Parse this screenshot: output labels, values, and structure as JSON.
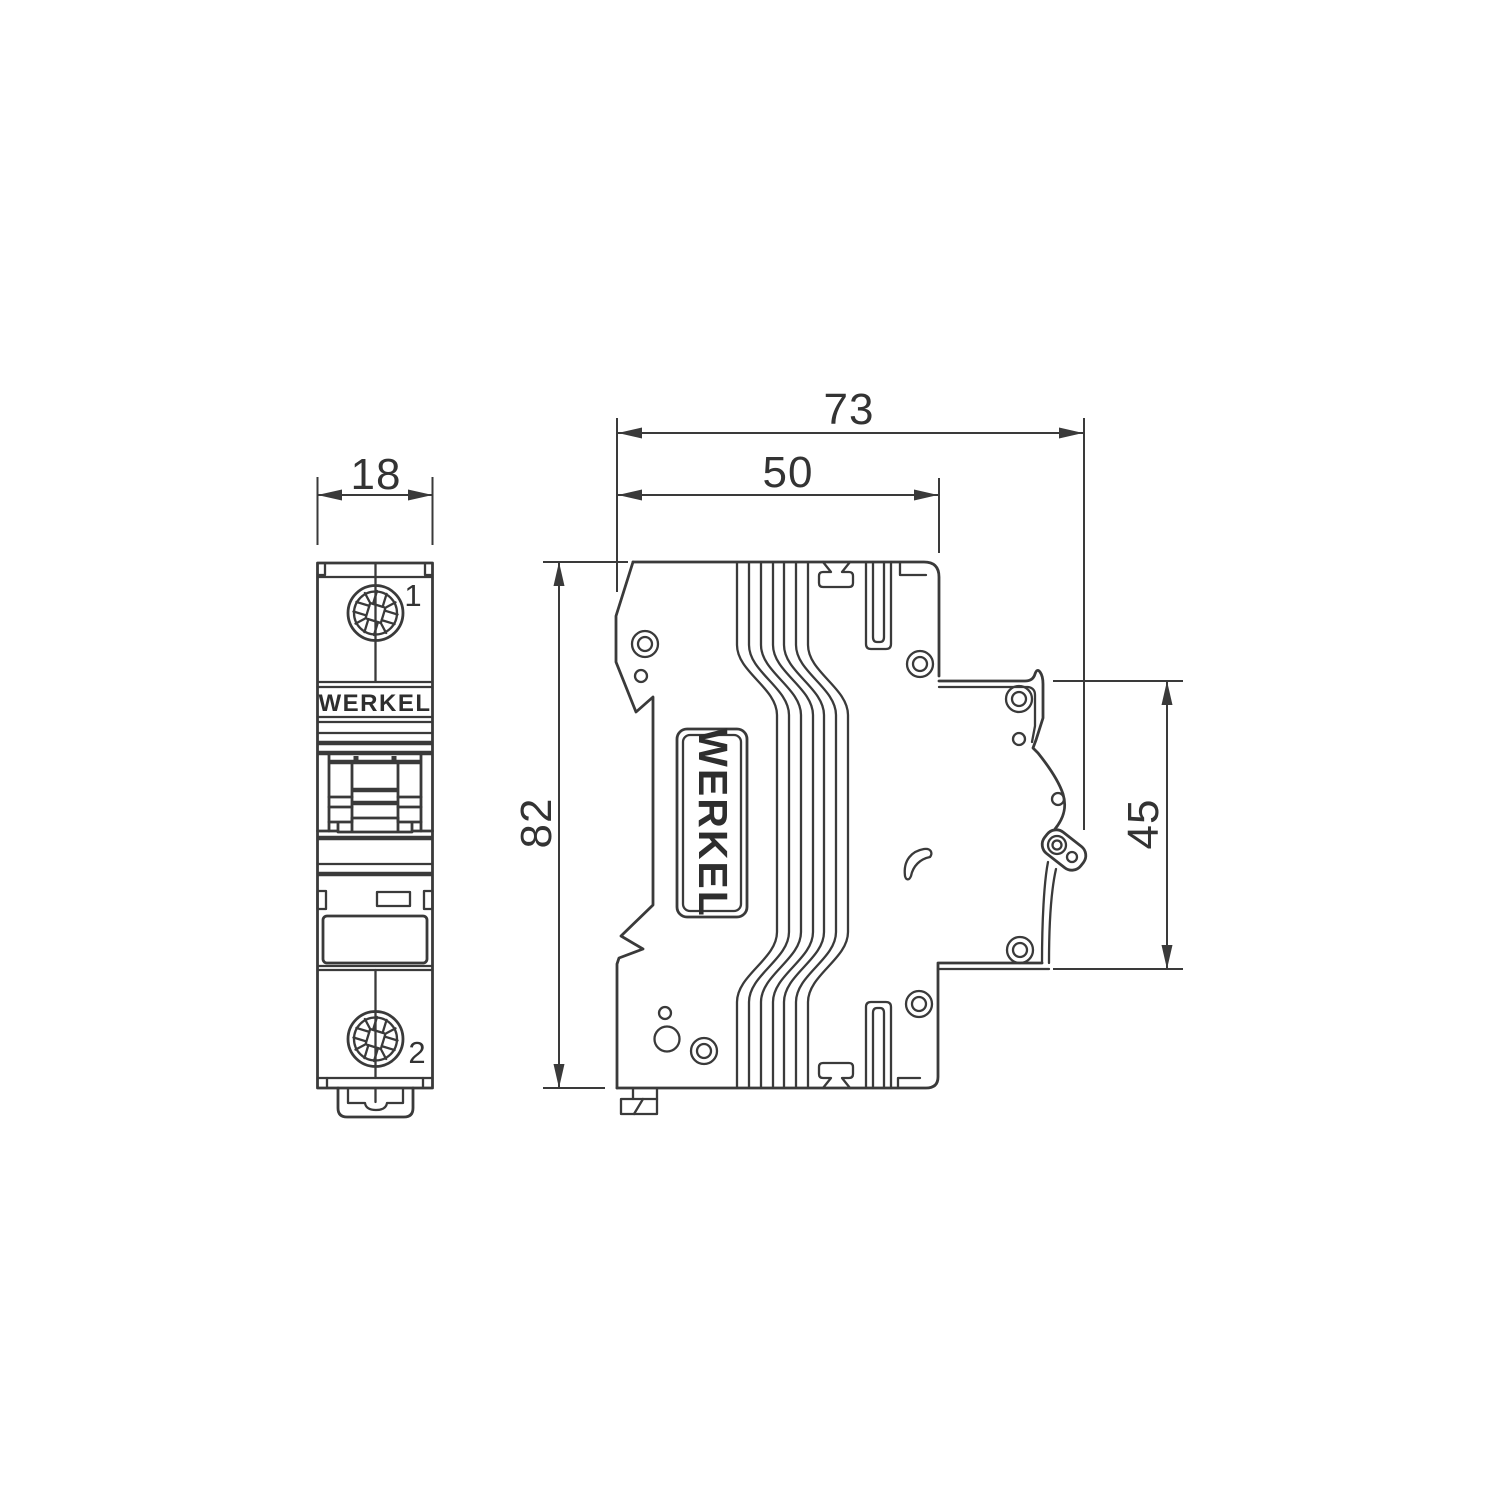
{
  "brand": "WERKEL",
  "front_view": {
    "dim_width": "18",
    "terminal_1": "1",
    "terminal_2": "2",
    "brand_label": "WERKEL"
  },
  "side_view": {
    "dim_total_depth": "73",
    "dim_body_depth": "50",
    "dim_height": "82",
    "dim_rail_height": "45",
    "brand_label": "WERKEL"
  },
  "colors": {
    "line": "#3a3a3a",
    "text": "#333333",
    "background": "#ffffff"
  }
}
